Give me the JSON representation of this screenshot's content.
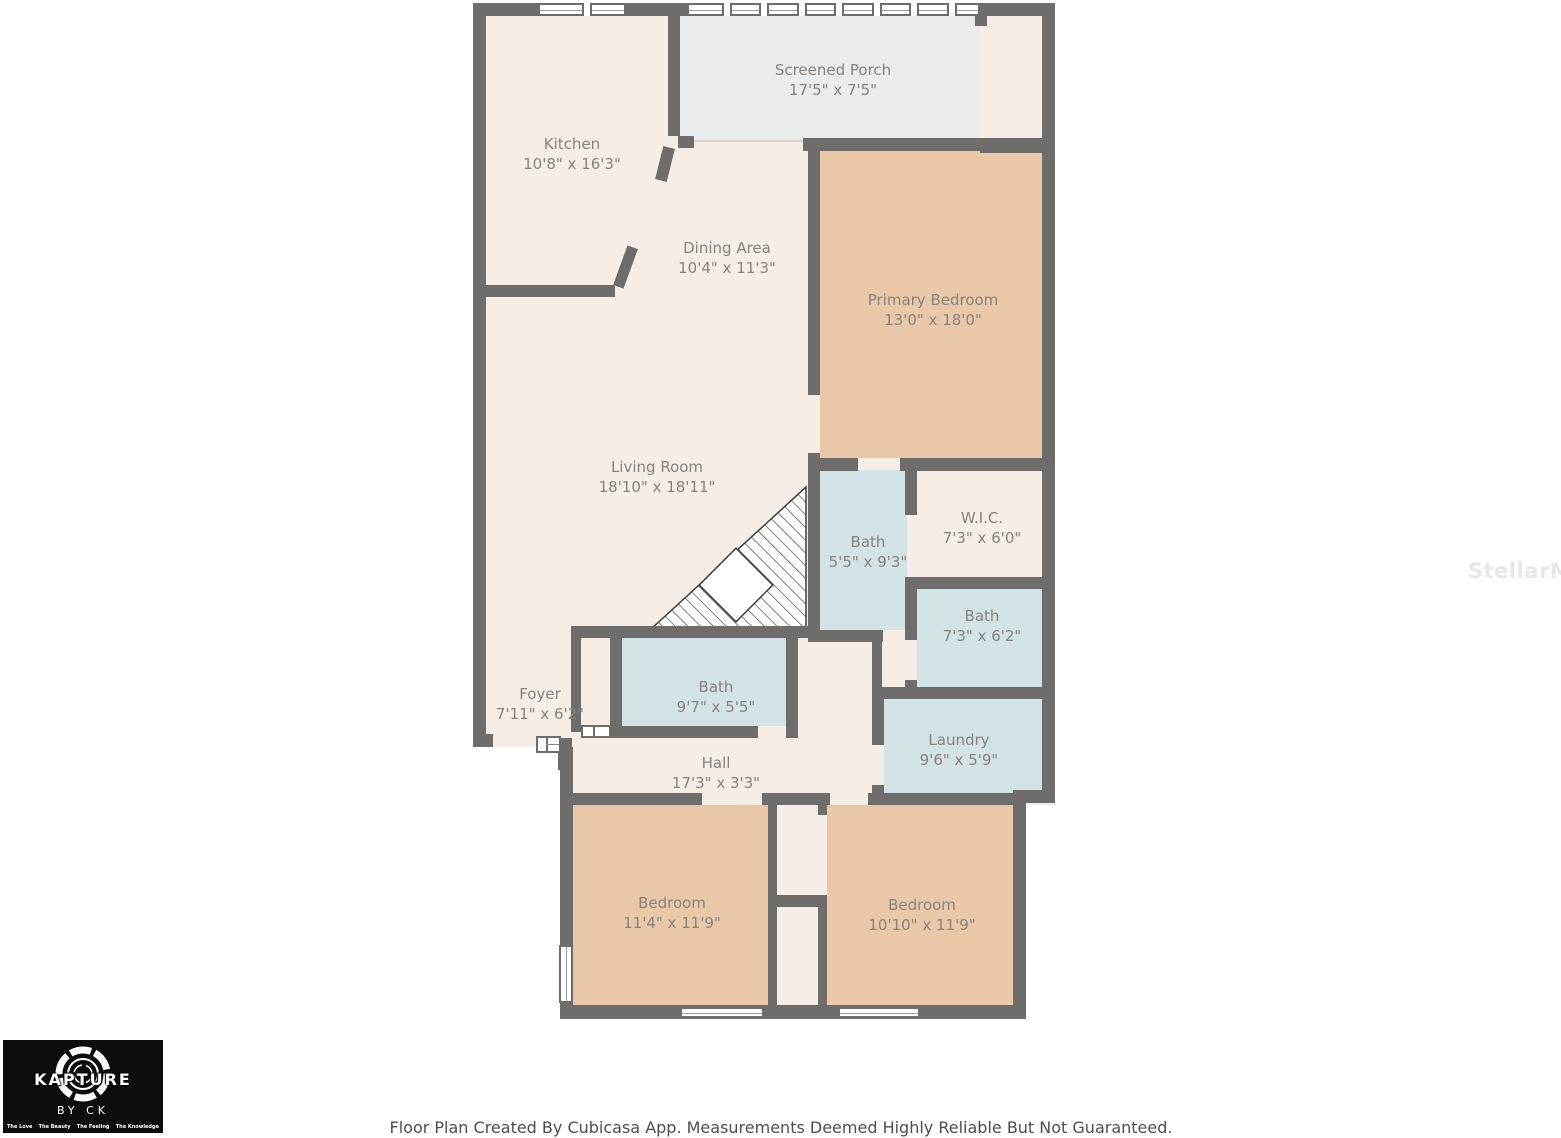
{
  "rooms": {
    "screened_porch": {
      "name": "Screened Porch",
      "dims": "17'5\" x 7'5\""
    },
    "kitchen": {
      "name": "Kitchen",
      "dims": "10'8\" x 16'3\""
    },
    "dining": {
      "name": "Dining Area",
      "dims": "10'4\" x 11'3\""
    },
    "primary": {
      "name": "Primary Bedroom",
      "dims": "13'0\" x 18'0\""
    },
    "living": {
      "name": "Living Room",
      "dims": "18'10\" x 18'11\""
    },
    "bath_primary": {
      "name": "Bath",
      "dims": "5'5\" x 9'3\""
    },
    "wic": {
      "name": "W.I.C.",
      "dims": "7'3\" x 6'0\""
    },
    "bath_hall": {
      "name": "Bath",
      "dims": "7'3\" x 6'2\""
    },
    "bath_front": {
      "name": "Bath",
      "dims": "9'7\" x 5'5\""
    },
    "foyer": {
      "name": "Foyer",
      "dims": "7'11\" x 6'2\""
    },
    "laundry": {
      "name": "Laundry",
      "dims": "9'6\" x 5'9\""
    },
    "hall": {
      "name": "Hall",
      "dims": "17'3\" x 3'3\""
    },
    "bedroom_left": {
      "name": "Bedroom",
      "dims": "11'4\" x 11'9\""
    },
    "bedroom_right": {
      "name": "Bedroom",
      "dims": "10'10\" x 11'9\""
    }
  },
  "logo": {
    "brand": "KAPTURE",
    "sub": "BY CK",
    "taglines": [
      "The Love",
      "The Beauty",
      "The Feeling",
      "The Knowledge"
    ]
  },
  "footer": {
    "text": "Floor Plan Created By Cubicasa App. Measurements Deemed Highly Reliable But Not Guaranteed."
  },
  "watermark": "StellarMLS",
  "colors": {
    "floor": "#f6eee6",
    "bedroom_fill": "#eac8a7",
    "bath_fill": "#d2e2e5",
    "porch_fill": "#eaebed",
    "wall": "#6e6d6c",
    "label_text": "#85827f"
  }
}
